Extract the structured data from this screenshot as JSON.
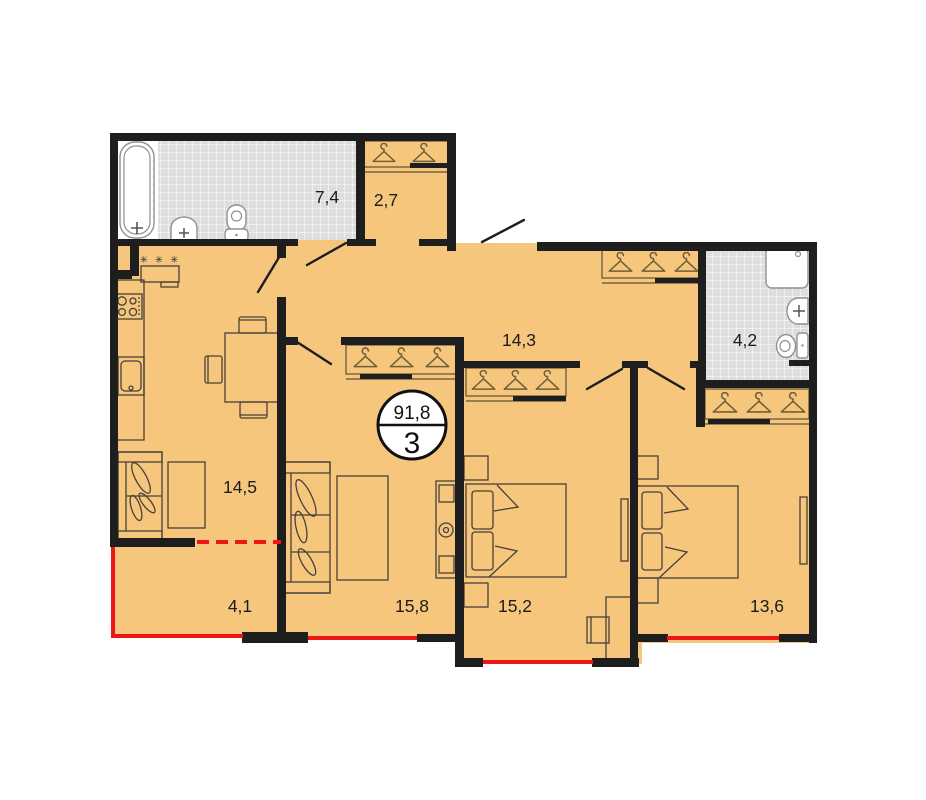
{
  "plan": {
    "badge": {
      "total_area": "91,8",
      "rooms_count": "3"
    },
    "areas": {
      "bathroom_main": "7,4",
      "hall_wardrobe": "2,7",
      "corridor": "14,3",
      "bathroom_small": "4,2",
      "kitchen_living": "14,5",
      "balcony": "4,1",
      "living_room": "15,8",
      "bedroom_one": "15,2",
      "bedroom_two": "13,6"
    },
    "symbols": {
      "appliance_marks": "✳ ✳ ✳"
    },
    "colors": {
      "floor": "#f6c67c",
      "walls": "#1e1e1e",
      "tiles": "#dedede",
      "window_line": "#ee1515",
      "fixtures": "#919191",
      "furniture": "#46413a",
      "hangers": "#6f603a"
    }
  }
}
